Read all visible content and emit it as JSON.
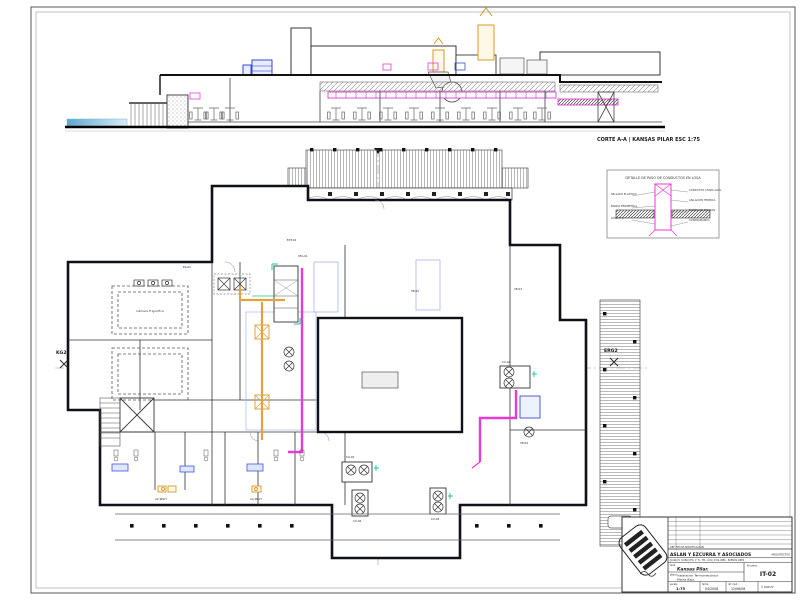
{
  "sheet": {
    "type": "architectural drawing sheet"
  },
  "section": {
    "caption": "CORTE A-A  |  KANSAS PILAR ESC 1:75"
  },
  "detail": {
    "title": "DETALLE DE PASO DE CONDUCTOS EN LOSA",
    "labels_left": [
      "SELLADO ELASTICO",
      "BANDA PERIMETRAL",
      "LOSA H°A°"
    ],
    "labels_right": [
      "CONDUCTO CHAPA GALV.",
      "AISLACION TERMICA",
      "MARCO DE FIJACION",
      "CONTRAMARCO"
    ]
  },
  "plan": {
    "axis_left": "KG2",
    "axis_right": "ERG2",
    "cold_room": "Cámara Frigorífica",
    "tags": [
      "EA-01",
      "UTA-01",
      "VE-02",
      "VE-03",
      "CU-01",
      "CU-02",
      "CU-03",
      "VE-04",
      "AA SPLIT",
      "AA SPLIT",
      "CU-04",
      "EXT-01"
    ]
  },
  "titleblock": {
    "rev_header": "REF.   FECHA   MODIFICACION",
    "firm": "ASLAN Y EZCURRA Y ASOCIADOS",
    "firm_right": "ARQUITECTOS",
    "address": "JUANA M. (CUBA) 876, 1° B - TEL. (011) 4314-4886 - BUENOS AIRES",
    "obra_label": "obra:",
    "obra": "Kansas Pilar.",
    "plano_label": "plano:",
    "plano_line1": "Instalación Termomecánica",
    "plano_line2": "Planta Baja.",
    "num_label": "Nº plano:",
    "num": "IT-02",
    "escala_label": "escala:",
    "escala": "1:75",
    "fecha_label": "fecha:",
    "fecha": "04/2008",
    "rev_label": "últ. mod.:",
    "rev": "12/06/08",
    "copy": "© COPIA N°"
  },
  "colors": {
    "duct_magenta": "#e83bd4",
    "duct_yellow": "#e2a23c",
    "duct_blue": "#3c50c8",
    "zone_blue": "#a8b4e4",
    "equip_green": "#18c89c",
    "water": "#76b4d8",
    "wall": "#101018",
    "hatch": "#9a9a9a"
  }
}
